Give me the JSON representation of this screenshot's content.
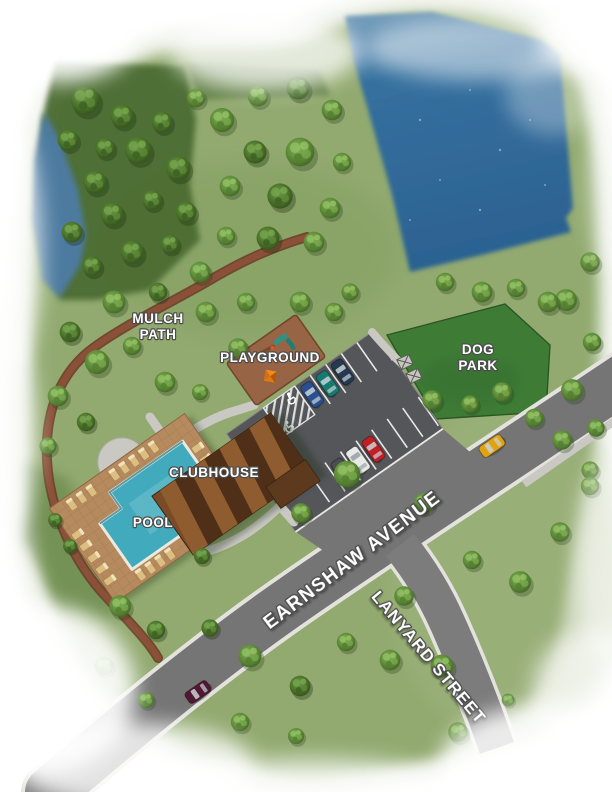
{
  "site_plan": {
    "description": "community-site-plan-illustration",
    "labels": {
      "mulch_path": [
        "MULCH",
        "PATH"
      ],
      "playground": "PLAYGROUND",
      "dog_park": [
        "DOG",
        "PARK"
      ],
      "clubhouse": "CLUBHOUSE",
      "pool": "POOL",
      "avenue": "EARNSHAW AVENUE",
      "street": "LANYARD STREET"
    },
    "colors": {
      "lake": "#35709f",
      "pond": "#4d7ba6",
      "grass": "#92aa6f",
      "forest": "#4c6c31",
      "dog_park": "#3e7c36",
      "mulch": "#8a5138",
      "playground_mulch": "#976446",
      "road": "#757575",
      "parking": "#55565a",
      "sidewalk": "#c9c8c3",
      "pool_water": "#41aabd",
      "pool_deck": "#b58a5e",
      "roof": "#7a4b26",
      "label": "#ffffff"
    },
    "cars": [
      {
        "name": "blue-sedan",
        "color": "#2a4f8f"
      },
      {
        "name": "teal-suv",
        "color": "#177a6e"
      },
      {
        "name": "navy-suv",
        "color": "#253950"
      },
      {
        "name": "dark-hatchback",
        "color": "#4a4e52"
      },
      {
        "name": "white-van",
        "color": "#e9e9e7"
      },
      {
        "name": "red-sedan",
        "color": "#c01f24"
      },
      {
        "name": "yellow-sedan",
        "color": "#e0a413"
      },
      {
        "name": "maroon-sedan",
        "color": "#521732"
      }
    ]
  }
}
